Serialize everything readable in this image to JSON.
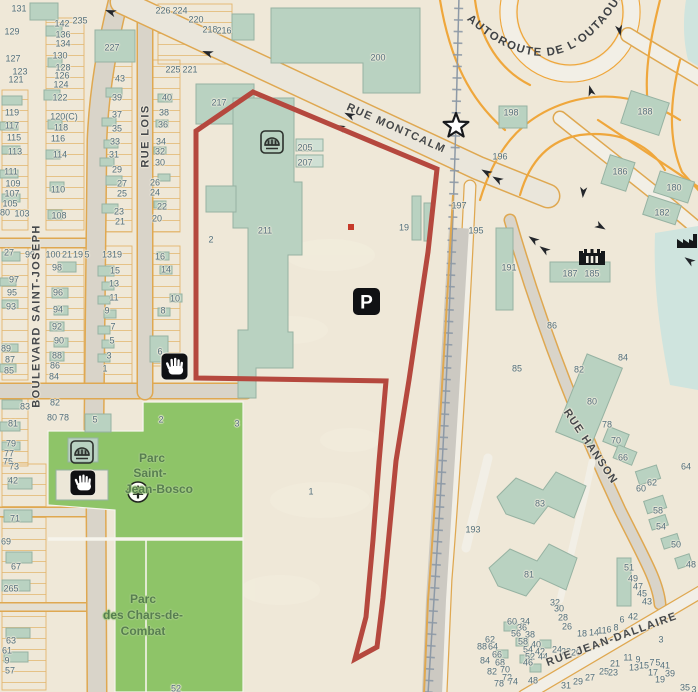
{
  "map": {
    "autoroute_label": "AUTOROUTE DE L'OUTAOUAIS",
    "parking_glyph": "P",
    "street_labels": [
      {
        "text": "BOULEVARD SAINT-JOSEPH",
        "x": 37,
        "y": 316,
        "rot": -90
      },
      {
        "text": "RUE LOIS",
        "x": 146,
        "y": 136,
        "rot": -90
      },
      {
        "text": "RUE MONTCALM",
        "x": 396,
        "y": 129,
        "rot": 24
      },
      {
        "text": "RUE HANSON",
        "x": 590,
        "y": 447,
        "rot": 56
      },
      {
        "text": "RUE JEAN-DALLAIRE",
        "x": 612,
        "y": 640,
        "rot": -20
      }
    ],
    "park_labels": [
      {
        "text": "Parc",
        "x": 152,
        "y": 458
      },
      {
        "text": "Saint-",
        "x": 150,
        "y": 473
      },
      {
        "text": "Jean-Bosco",
        "x": 159,
        "y": 489
      },
      {
        "text": "Parc",
        "x": 143,
        "y": 599
      },
      {
        "text": "des Chars-de-",
        "x": 143,
        "y": 615
      },
      {
        "text": "Combat",
        "x": 143,
        "y": 631
      }
    ],
    "address_labels": [
      {
        "t": "131",
        "x": 19,
        "y": 9
      },
      {
        "t": "129",
        "x": 12,
        "y": 32
      },
      {
        "t": "127",
        "x": 13,
        "y": 59
      },
      {
        "t": "123",
        "x": 20,
        "y": 72
      },
      {
        "t": "121",
        "x": 16,
        "y": 80
      },
      {
        "t": "119",
        "x": 12,
        "y": 113
      },
      {
        "t": "117",
        "x": 12,
        "y": 126
      },
      {
        "t": "115",
        "x": 14,
        "y": 138
      },
      {
        "t": "113",
        "x": 15,
        "y": 152
      },
      {
        "t": "111",
        "x": 11,
        "y": 172
      },
      {
        "t": "109",
        "x": 13,
        "y": 184
      },
      {
        "t": "107",
        "x": 12,
        "y": 194
      },
      {
        "t": "105",
        "x": 10,
        "y": 204
      },
      {
        "t": "80",
        "x": 5,
        "y": 213
      },
      {
        "t": "103",
        "x": 22,
        "y": 214
      },
      {
        "t": "27",
        "x": 9,
        "y": 253
      },
      {
        "t": "99",
        "x": 30,
        "y": 255
      },
      {
        "t": "97",
        "x": 14,
        "y": 280
      },
      {
        "t": "95",
        "x": 12,
        "y": 293
      },
      {
        "t": "93",
        "x": 11,
        "y": 307
      },
      {
        "t": "89",
        "x": 6,
        "y": 349
      },
      {
        "t": "87",
        "x": 10,
        "y": 360
      },
      {
        "t": "85",
        "x": 9,
        "y": 371
      },
      {
        "t": "83",
        "x": 25,
        "y": 407
      },
      {
        "t": "81",
        "x": 13,
        "y": 424
      },
      {
        "t": "79",
        "x": 11,
        "y": 444
      },
      {
        "t": "77",
        "x": 9,
        "y": 454
      },
      {
        "t": "75",
        "x": 8,
        "y": 462
      },
      {
        "t": "73",
        "x": 14,
        "y": 467
      },
      {
        "t": "42",
        "x": 13,
        "y": 481
      },
      {
        "t": "71",
        "x": 15,
        "y": 519
      },
      {
        "t": "69",
        "x": 6,
        "y": 542
      },
      {
        "t": "67",
        "x": 16,
        "y": 567
      },
      {
        "t": "265",
        "x": 11,
        "y": 589
      },
      {
        "t": "63",
        "x": 11,
        "y": 641
      },
      {
        "t": "61",
        "x": 7,
        "y": 651
      },
      {
        "t": "9",
        "x": 7,
        "y": 661
      },
      {
        "t": "57",
        "x": 10,
        "y": 671
      },
      {
        "t": "142",
        "x": 62,
        "y": 24
      },
      {
        "t": "235",
        "x": 80,
        "y": 21
      },
      {
        "t": "136",
        "x": 63,
        "y": 35
      },
      {
        "t": "134",
        "x": 63,
        "y": 44
      },
      {
        "t": "130",
        "x": 60,
        "y": 56
      },
      {
        "t": "128",
        "x": 63,
        "y": 68
      },
      {
        "t": "126",
        "x": 62,
        "y": 76
      },
      {
        "t": "124",
        "x": 61,
        "y": 85
      },
      {
        "t": "122",
        "x": 60,
        "y": 98
      },
      {
        "t": "120(C)",
        "x": 64,
        "y": 117
      },
      {
        "t": "118",
        "x": 61,
        "y": 128
      },
      {
        "t": "116",
        "x": 58,
        "y": 139
      },
      {
        "t": "114",
        "x": 60,
        "y": 155
      },
      {
        "t": "110",
        "x": 58,
        "y": 190
      },
      {
        "t": "108",
        "x": 59,
        "y": 216
      },
      {
        "t": "100",
        "x": 53,
        "y": 255
      },
      {
        "t": "21",
        "x": 67,
        "y": 255
      },
      {
        "t": "19",
        "x": 78,
        "y": 255
      },
      {
        "t": "5",
        "x": 87,
        "y": 255
      },
      {
        "t": "98",
        "x": 57,
        "y": 268
      },
      {
        "t": "96",
        "x": 58,
        "y": 293
      },
      {
        "t": "94",
        "x": 58,
        "y": 310
      },
      {
        "t": "92",
        "x": 57,
        "y": 327
      },
      {
        "t": "90",
        "x": 59,
        "y": 341
      },
      {
        "t": "88",
        "x": 57,
        "y": 356
      },
      {
        "t": "86",
        "x": 55,
        "y": 366
      },
      {
        "t": "84",
        "x": 54,
        "y": 377
      },
      {
        "t": "82",
        "x": 55,
        "y": 403
      },
      {
        "t": "80",
        "x": 52,
        "y": 418
      },
      {
        "t": "78",
        "x": 64,
        "y": 418
      },
      {
        "t": "5",
        "x": 95,
        "y": 420
      },
      {
        "t": "43",
        "x": 120,
        "y": 79
      },
      {
        "t": "39",
        "x": 117,
        "y": 98
      },
      {
        "t": "37",
        "x": 117,
        "y": 115
      },
      {
        "t": "35",
        "x": 117,
        "y": 129
      },
      {
        "t": "33",
        "x": 115,
        "y": 142
      },
      {
        "t": "31",
        "x": 114,
        "y": 155
      },
      {
        "t": "29",
        "x": 117,
        "y": 170
      },
      {
        "t": "27",
        "x": 122,
        "y": 184
      },
      {
        "t": "25",
        "x": 122,
        "y": 194
      },
      {
        "t": "23",
        "x": 119,
        "y": 212
      },
      {
        "t": "21",
        "x": 120,
        "y": 222
      },
      {
        "t": "13",
        "x": 107,
        "y": 255
      },
      {
        "t": "19",
        "x": 117,
        "y": 255
      },
      {
        "t": "15",
        "x": 115,
        "y": 271
      },
      {
        "t": "13",
        "x": 114,
        "y": 284
      },
      {
        "t": "11",
        "x": 114,
        "y": 298
      },
      {
        "t": "9",
        "x": 107,
        "y": 311
      },
      {
        "t": "7",
        "x": 113,
        "y": 327
      },
      {
        "t": "5",
        "x": 112,
        "y": 341
      },
      {
        "t": "3",
        "x": 109,
        "y": 356
      },
      {
        "t": "1",
        "x": 105,
        "y": 369
      },
      {
        "t": "226",
        "x": 163,
        "y": 11
      },
      {
        "t": "224",
        "x": 180,
        "y": 11
      },
      {
        "t": "220",
        "x": 196,
        "y": 20
      },
      {
        "t": "218",
        "x": 210,
        "y": 30
      },
      {
        "t": "216",
        "x": 224,
        "y": 31
      },
      {
        "t": "225",
        "x": 173,
        "y": 70
      },
      {
        "t": "221",
        "x": 190,
        "y": 70
      },
      {
        "t": "40",
        "x": 167,
        "y": 98
      },
      {
        "t": "38",
        "x": 164,
        "y": 113
      },
      {
        "t": "36",
        "x": 163,
        "y": 125
      },
      {
        "t": "34",
        "x": 161,
        "y": 142
      },
      {
        "t": "32",
        "x": 160,
        "y": 152
      },
      {
        "t": "30",
        "x": 160,
        "y": 163
      },
      {
        "t": "26",
        "x": 155,
        "y": 183
      },
      {
        "t": "24",
        "x": 155,
        "y": 193
      },
      {
        "t": "22",
        "x": 162,
        "y": 207
      },
      {
        "t": "20",
        "x": 157,
        "y": 219
      },
      {
        "t": "16",
        "x": 160,
        "y": 257
      },
      {
        "t": "14",
        "x": 166,
        "y": 270
      },
      {
        "t": "10",
        "x": 175,
        "y": 299
      },
      {
        "t": "8",
        "x": 163,
        "y": 311
      },
      {
        "t": "6",
        "x": 160,
        "y": 352
      },
      {
        "t": "227",
        "x": 112,
        "y": 48
      },
      {
        "t": "217",
        "x": 219,
        "y": 103
      },
      {
        "t": "211",
        "x": 265,
        "y": 231
      },
      {
        "t": "205",
        "x": 305,
        "y": 148
      },
      {
        "t": "207",
        "x": 305,
        "y": 163
      },
      {
        "t": "200",
        "x": 378,
        "y": 58
      },
      {
        "t": "2",
        "x": 211,
        "y": 240
      },
      {
        "t": "19",
        "x": 404,
        "y": 228
      },
      {
        "t": "198",
        "x": 511,
        "y": 113
      },
      {
        "t": "196",
        "x": 500,
        "y": 157
      },
      {
        "t": "197",
        "x": 459,
        "y": 206
      },
      {
        "t": "195",
        "x": 476,
        "y": 231
      },
      {
        "t": "188",
        "x": 645,
        "y": 112
      },
      {
        "t": "186",
        "x": 620,
        "y": 172
      },
      {
        "t": "180",
        "x": 674,
        "y": 188
      },
      {
        "t": "182",
        "x": 662,
        "y": 213
      },
      {
        "t": "191",
        "x": 509,
        "y": 268
      },
      {
        "t": "187",
        "x": 570,
        "y": 274
      },
      {
        "t": "185",
        "x": 592,
        "y": 274
      },
      {
        "t": "86",
        "x": 552,
        "y": 326
      },
      {
        "t": "85",
        "x": 517,
        "y": 369
      },
      {
        "t": "84",
        "x": 623,
        "y": 358
      },
      {
        "t": "82",
        "x": 579,
        "y": 370
      },
      {
        "t": "80",
        "x": 592,
        "y": 402
      },
      {
        "t": "78",
        "x": 607,
        "y": 425
      },
      {
        "t": "70",
        "x": 616,
        "y": 441
      },
      {
        "t": "66",
        "x": 623,
        "y": 458
      },
      {
        "t": "2",
        "x": 161,
        "y": 420
      },
      {
        "t": "3",
        "x": 237,
        "y": 424
      },
      {
        "t": "1",
        "x": 311,
        "y": 492
      },
      {
        "t": "52",
        "x": 176,
        "y": 689
      },
      {
        "t": "83",
        "x": 540,
        "y": 504
      },
      {
        "t": "81",
        "x": 529,
        "y": 575
      },
      {
        "t": "193",
        "x": 473,
        "y": 530
      },
      {
        "t": "64",
        "x": 686,
        "y": 467
      },
      {
        "t": "62",
        "x": 652,
        "y": 483
      },
      {
        "t": "60",
        "x": 641,
        "y": 489
      },
      {
        "t": "58",
        "x": 658,
        "y": 511
      },
      {
        "t": "54",
        "x": 661,
        "y": 527
      },
      {
        "t": "50",
        "x": 676,
        "y": 545
      },
      {
        "t": "48",
        "x": 691,
        "y": 565
      },
      {
        "t": "51",
        "x": 629,
        "y": 568
      },
      {
        "t": "49",
        "x": 633,
        "y": 579
      },
      {
        "t": "47",
        "x": 638,
        "y": 587
      },
      {
        "t": "45",
        "x": 642,
        "y": 594
      },
      {
        "t": "43",
        "x": 647,
        "y": 602
      },
      {
        "t": "42",
        "x": 633,
        "y": 617
      },
      {
        "t": "6",
        "x": 622,
        "y": 620
      },
      {
        "t": "32",
        "x": 555,
        "y": 603
      },
      {
        "t": "30",
        "x": 559,
        "y": 609
      },
      {
        "t": "28",
        "x": 563,
        "y": 618
      },
      {
        "t": "26",
        "x": 567,
        "y": 627
      },
      {
        "t": "3",
        "x": 661,
        "y": 640
      },
      {
        "t": "60",
        "x": 512,
        "y": 622
      },
      {
        "t": "34",
        "x": 525,
        "y": 622
      },
      {
        "t": "36",
        "x": 522,
        "y": 628
      },
      {
        "t": "56",
        "x": 516,
        "y": 634
      },
      {
        "t": "38",
        "x": 530,
        "y": 635
      },
      {
        "t": "58",
        "x": 523,
        "y": 642
      },
      {
        "t": "40",
        "x": 536,
        "y": 645
      },
      {
        "t": "54",
        "x": 528,
        "y": 650
      },
      {
        "t": "42",
        "x": 540,
        "y": 652
      },
      {
        "t": "52",
        "x": 530,
        "y": 657
      },
      {
        "t": "44",
        "x": 543,
        "y": 657
      },
      {
        "t": "46",
        "x": 528,
        "y": 663
      },
      {
        "t": "48",
        "x": 533,
        "y": 681
      },
      {
        "t": "62",
        "x": 490,
        "y": 640
      },
      {
        "t": "88",
        "x": 482,
        "y": 647
      },
      {
        "t": "64",
        "x": 493,
        "y": 647
      },
      {
        "t": "66",
        "x": 497,
        "y": 655
      },
      {
        "t": "84",
        "x": 485,
        "y": 661
      },
      {
        "t": "68",
        "x": 500,
        "y": 663
      },
      {
        "t": "70",
        "x": 505,
        "y": 670
      },
      {
        "t": "82",
        "x": 492,
        "y": 672
      },
      {
        "t": "72",
        "x": 507,
        "y": 678
      },
      {
        "t": "74",
        "x": 513,
        "y": 682
      },
      {
        "t": "78",
        "x": 499,
        "y": 684
      },
      {
        "t": "24",
        "x": 557,
        "y": 650
      },
      {
        "t": "22",
        "x": 566,
        "y": 652
      },
      {
        "t": "20",
        "x": 576,
        "y": 653
      },
      {
        "t": "18",
        "x": 582,
        "y": 634
      },
      {
        "t": "14",
        "x": 594,
        "y": 633
      },
      {
        "t": "11",
        "x": 602,
        "y": 631
      },
      {
        "t": "6",
        "x": 609,
        "y": 630
      },
      {
        "t": "8",
        "x": 616,
        "y": 628
      },
      {
        "t": "31",
        "x": 566,
        "y": 686
      },
      {
        "t": "29",
        "x": 578,
        "y": 682
      },
      {
        "t": "27",
        "x": 590,
        "y": 678
      },
      {
        "t": "25",
        "x": 604,
        "y": 672
      },
      {
        "t": "23",
        "x": 613,
        "y": 673
      },
      {
        "t": "21",
        "x": 615,
        "y": 664
      },
      {
        "t": "11",
        "x": 628,
        "y": 658
      },
      {
        "t": "9",
        "x": 638,
        "y": 660
      },
      {
        "t": "13",
        "x": 634,
        "y": 668
      },
      {
        "t": "15",
        "x": 644,
        "y": 666
      },
      {
        "t": "7",
        "x": 652,
        "y": 663
      },
      {
        "t": "5",
        "x": 658,
        "y": 663
      },
      {
        "t": "41",
        "x": 665,
        "y": 666
      },
      {
        "t": "17",
        "x": 653,
        "y": 673
      },
      {
        "t": "39",
        "x": 670,
        "y": 674
      },
      {
        "t": "19",
        "x": 660,
        "y": 680
      },
      {
        "t": "35",
        "x": 685,
        "y": 688
      },
      {
        "t": "3",
        "x": 694,
        "y": 690
      }
    ],
    "icons": [
      "parking-icon",
      "open-hand-icon",
      "dome-attraction-icon",
      "fort-museum-icon",
      "factory-icon",
      "star-poi-icon",
      "conifer-tree-icon",
      "one-way-arrow-icon"
    ],
    "colors": {
      "background": "#efe8d8",
      "parcel_line": "#dfa851",
      "road_fill": "#d9d4c9",
      "road_major": "#eae6db",
      "road_white": "#f2efe6",
      "building": "#b9d2c1",
      "building_border": "#96b2a2",
      "park": "#8ec468",
      "water": "#cfe4de",
      "rail": "#8d99a6",
      "rail_corridor": "#ccc9c2",
      "boundary_red": "#b5483e",
      "point_red": "#c63a2a",
      "address_text": "#54707d",
      "street_text": "#45484b",
      "park_text": "#577e50"
    }
  }
}
